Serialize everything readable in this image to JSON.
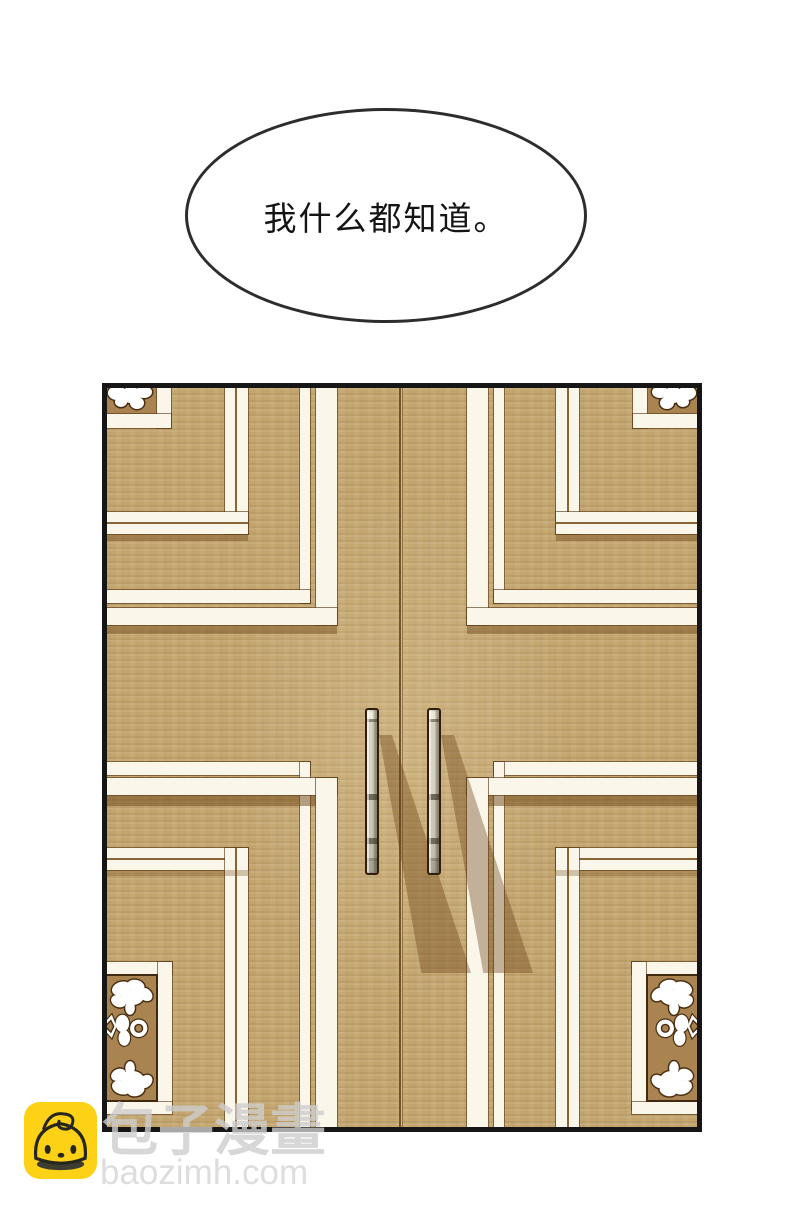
{
  "speech_bubble": {
    "text": "我什么都知道。"
  },
  "artwork": {
    "subject_icon": "ornate-double-doors-illustration",
    "colors": {
      "wood": "#c3a46c",
      "dark_wood": "#aa8450",
      "molding": "#faf6ea",
      "panel_border": "#161616",
      "handle_metal": "#cbc7b8"
    }
  },
  "watermark": {
    "site_name": "包子漫畫",
    "site_url": "baozimh.com",
    "logo_icon": "baozi-bun-icon",
    "logo_color": "#fcd116",
    "text_color": "#cdcdcd"
  }
}
